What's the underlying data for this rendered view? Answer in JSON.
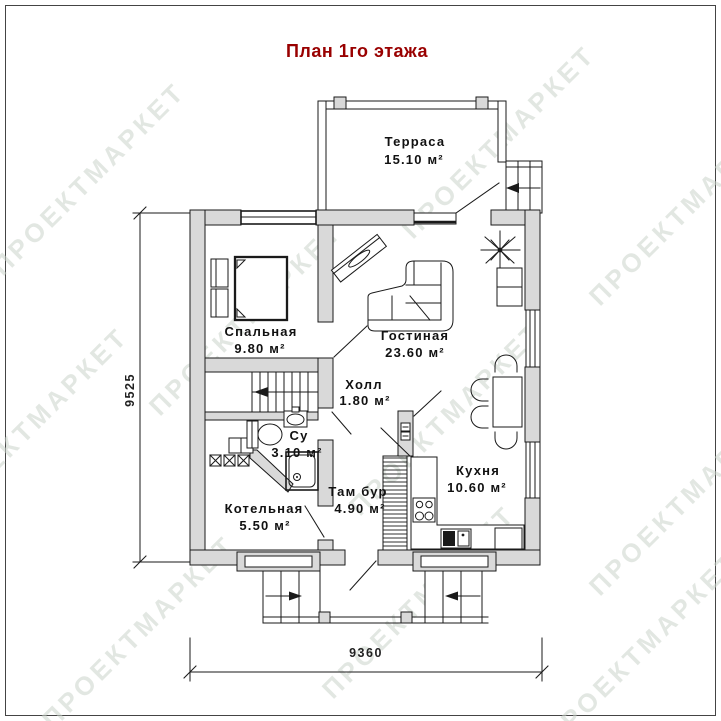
{
  "title": "План 1го этажа",
  "watermark": "ПРОЕКТМАРКЕТ",
  "colors": {
    "title_red": "#990000",
    "wall_gray": "#d9d9d9",
    "line_black": "#1a1a1a",
    "watermark_gray": "#ccd4cc"
  },
  "dimensions": {
    "height_mm": "9525",
    "width_mm": "9360"
  },
  "rooms": [
    {
      "name": "Терраса",
      "area": "15.10 м²"
    },
    {
      "name": "Спальная",
      "area": "9.80 м²"
    },
    {
      "name": "Гостиная",
      "area": "23.60 м²"
    },
    {
      "name": "Холл",
      "area": "1.80 м²"
    },
    {
      "name": "Су",
      "area": "3.10 м²"
    },
    {
      "name": "Там бур",
      "area": "4.90 м²"
    },
    {
      "name": "Котельная",
      "area": "5.50 м²"
    },
    {
      "name": "Кухня",
      "area": "10.60 м²"
    }
  ]
}
